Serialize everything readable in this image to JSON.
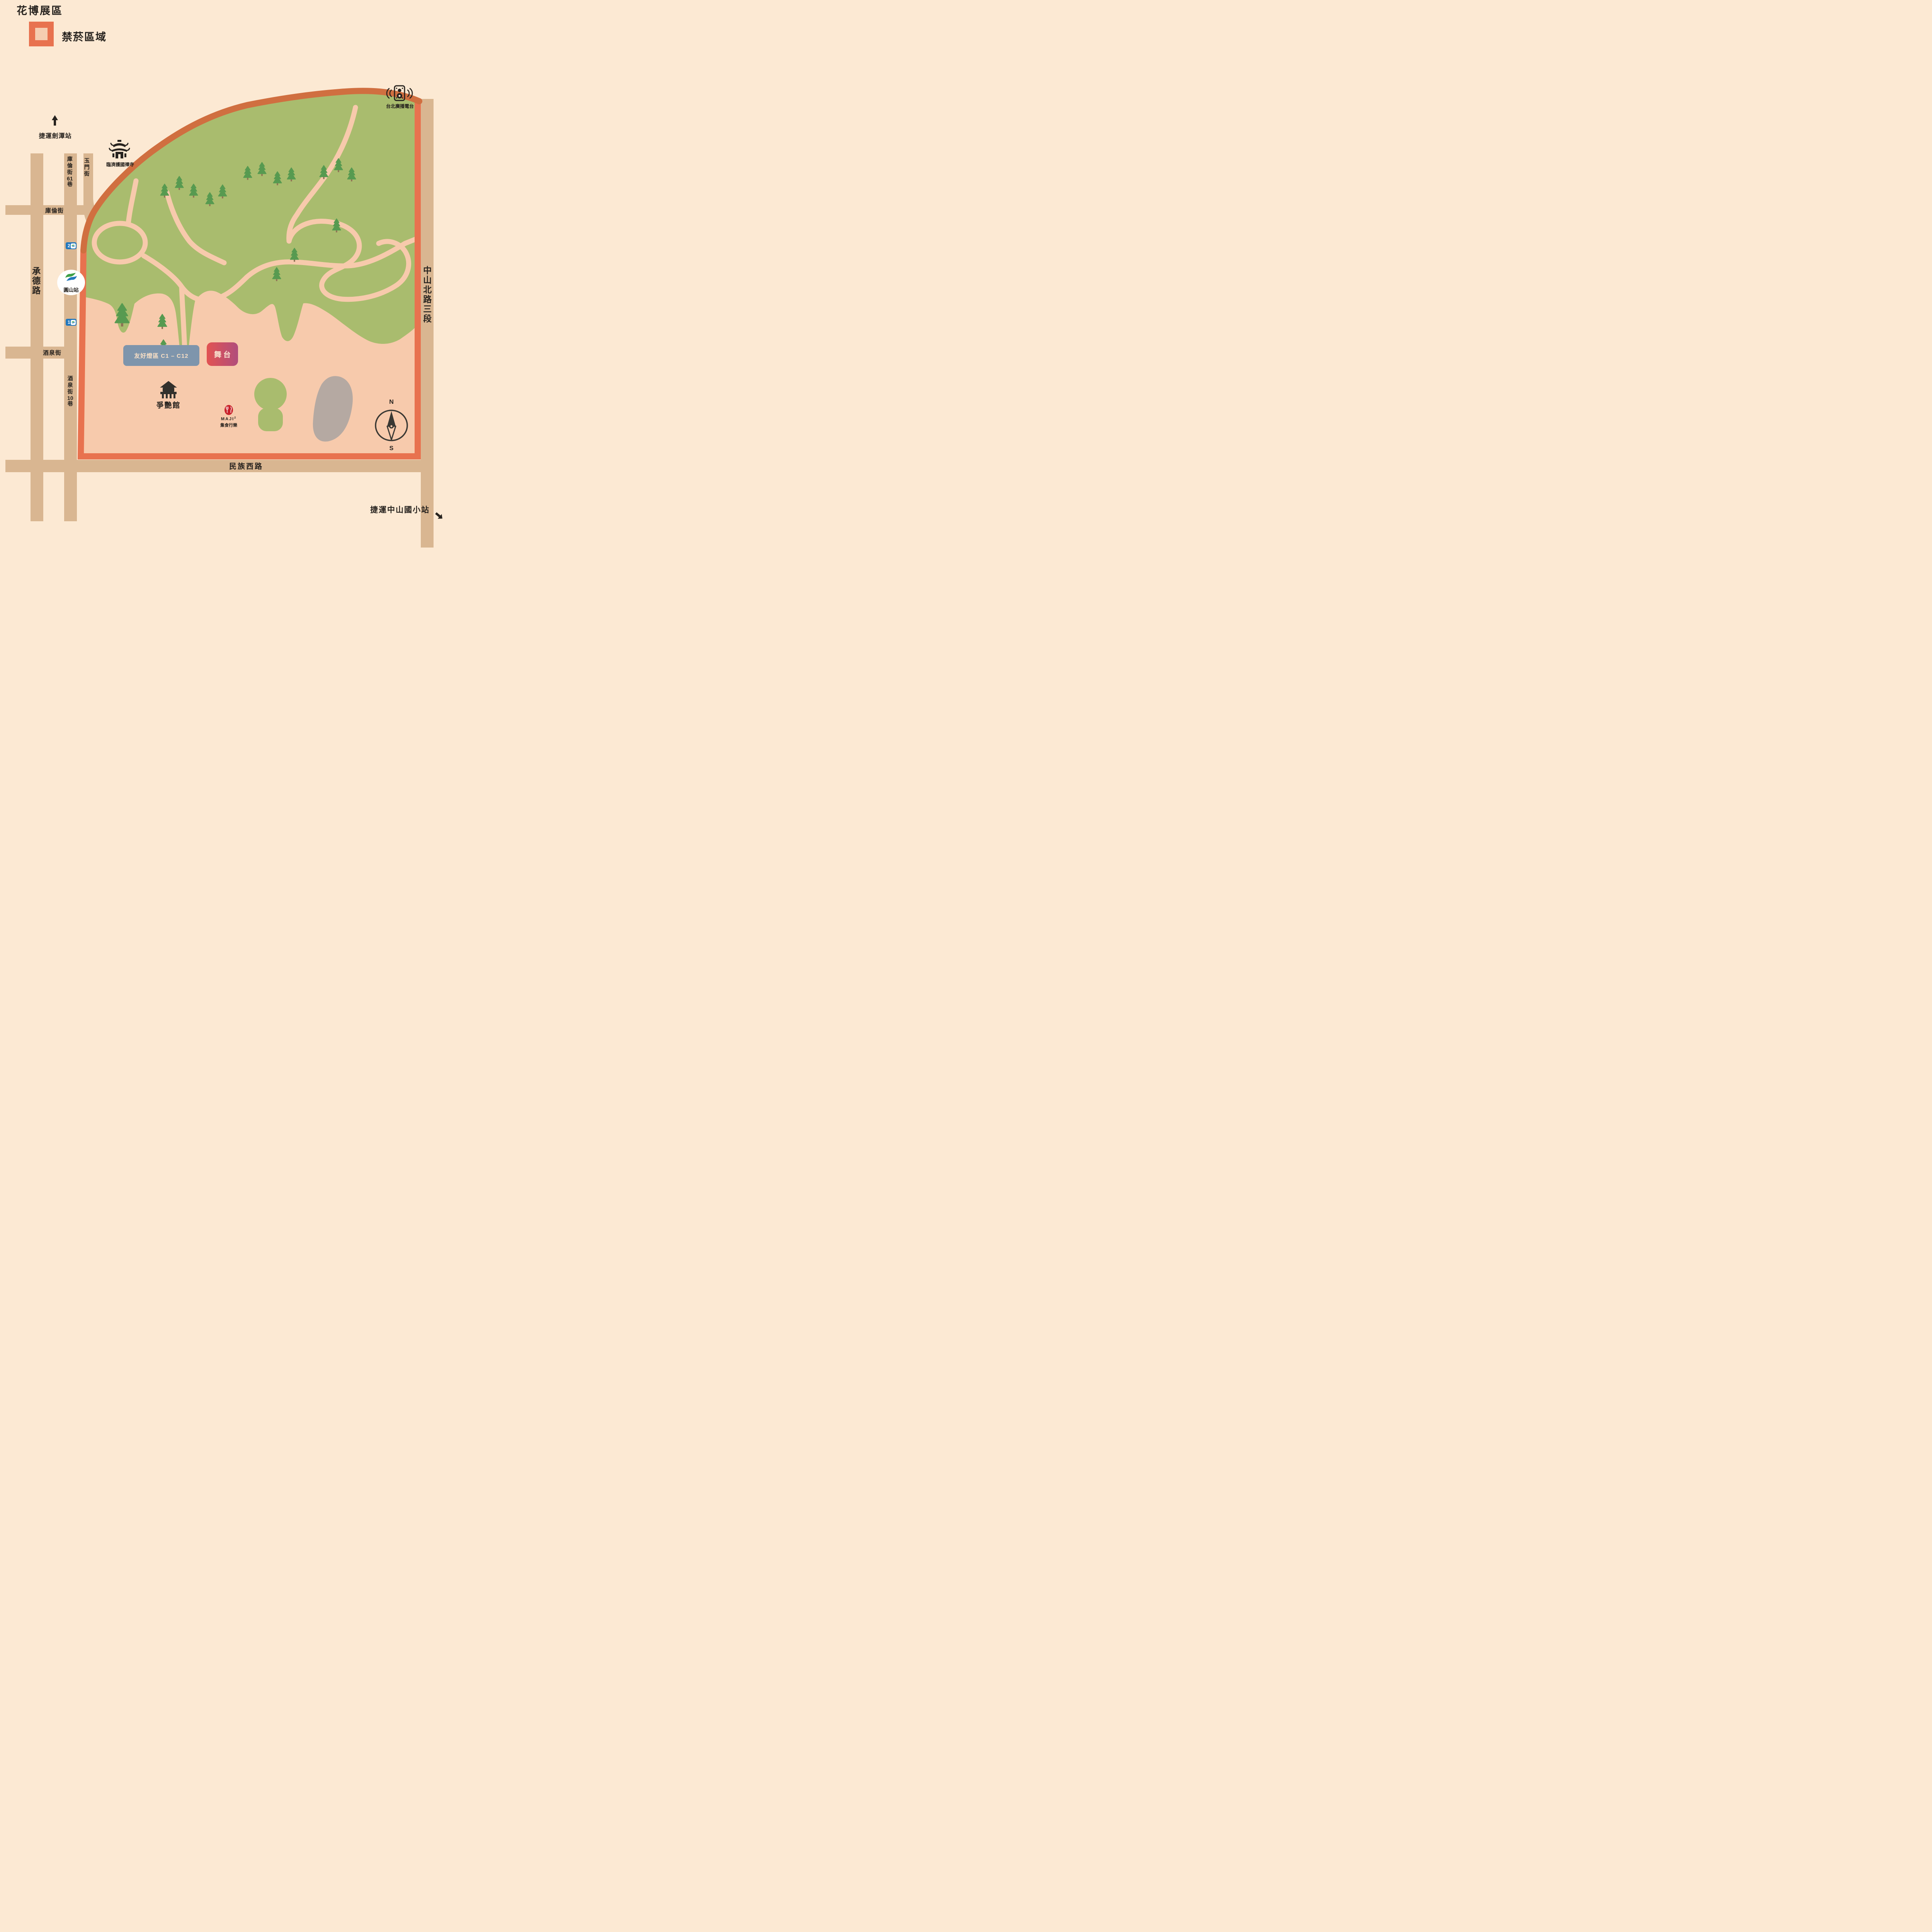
{
  "title": "花博展區",
  "legend": {
    "label": "禁菸區域"
  },
  "stations": {
    "jiantan": "捷運劍潭站",
    "yuanshan": "圓山站",
    "zhongshan_elementary": "捷運中山國小站",
    "exit1": "1",
    "exit2": "2"
  },
  "landmarks": {
    "temple": "臨濟護國禪寺",
    "radio": "台北廣播電台",
    "expo_dome": "爭艷館",
    "maji_name": "MAJI",
    "maji_sup": "2",
    "maji_sub": "集食行樂"
  },
  "areas": {
    "lantern_zone": "友好燈區 C1 – C12",
    "stage": "舞台"
  },
  "roads": {
    "chengde": "承德路",
    "kulun_lane61": {
      "p1": "庫倫街",
      "digits": "61",
      "p2": "巷"
    },
    "yumen": "玉門街",
    "kulun": "庫倫街",
    "jiuquan": "酒泉街",
    "jiuquan_lane10": {
      "p1": "酒泉街",
      "digits": "10",
      "p2": "巷"
    },
    "zhongshan_n_rd": "中山北路三段",
    "minzu_w_rd": "民族西路"
  },
  "compass": {
    "north": "N",
    "south": "S"
  },
  "colors": {
    "background": "#fce9d3",
    "road": "#d9b691",
    "zone_fill": "#f7caac",
    "zone_border": "#e8724f",
    "zone_border_hill": "#d06f40",
    "park_green": "#a9bc6e",
    "tree_green": "#579a50",
    "tree_trunk": "#8f7355",
    "lantern_box": "#7e95ac",
    "stage_gradient_left": "#e25352",
    "stage_gradient_right": "#b04e7c",
    "metro_blue": "#2478bd",
    "metro_green": "#3fa047",
    "maji_red": "#c9222b",
    "gray_area": "#b5a9a2",
    "ink": "#26221e"
  }
}
